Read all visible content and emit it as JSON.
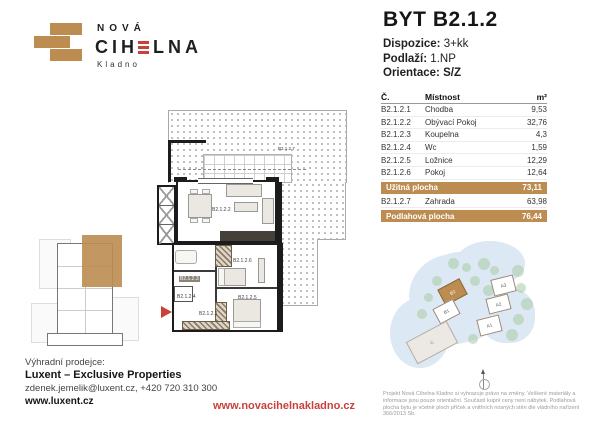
{
  "colors": {
    "brand_tan": "#BC8C50",
    "brand_red": "#C8423C",
    "wall_black": "#1c1c1c",
    "siteplan_blue": "#DCE8F3",
    "tree_green": "#A9CBA4"
  },
  "logo": {
    "line1": "NOVÁ",
    "word_pre": "CIH",
    "word_post": "LNA",
    "city": "Kladno"
  },
  "unit": {
    "title": "BYT B2.1.2",
    "specs": [
      {
        "label": "Dispozice:",
        "value": "3+kk"
      },
      {
        "label": "Podlaží:",
        "value": "1.NP"
      },
      {
        "label": "Orientace:",
        "value": "S/Z"
      }
    ]
  },
  "table": {
    "col_num": "Č.",
    "col_room": "Místnost",
    "col_area": "m²",
    "rows": [
      {
        "num": "B2.1.2.1",
        "room": "Chodba",
        "area": "9,53"
      },
      {
        "num": "B2.1.2.2",
        "room": "Obývací Pokoj",
        "area": "32,76"
      },
      {
        "num": "B2.1.2.3",
        "room": "Koupelna",
        "area": "4,3"
      },
      {
        "num": "B2.1.2.4",
        "room": "Wc",
        "area": "1,59"
      },
      {
        "num": "B2.1.2.5",
        "room": "Ložnice",
        "area": "12,29"
      },
      {
        "num": "B2.1.2.6",
        "room": "Pokoj",
        "area": "12,64"
      }
    ],
    "usable": {
      "label": "Užitná plocha",
      "area": "73,11"
    },
    "garden_row": {
      "num": "B2.1.2.7",
      "room": "Zahrada",
      "area": "63,98"
    },
    "floor_total": {
      "label": "Podlahová plocha",
      "area": "76,44"
    }
  },
  "floorplan": {
    "labels": {
      "living": "B2.1.2.2",
      "garden": "B2.1.2.7",
      "hall": "B2.1.2.1",
      "bath": "B2.1.2.3",
      "wc": "B2.1.2.4",
      "bedroom": "B2.1.2.5",
      "room": "B2.1.2.6"
    }
  },
  "siteplan": {
    "buildings": [
      {
        "label": "B2"
      },
      {
        "label": "B1"
      },
      {
        "label": "A3"
      },
      {
        "label": "A2"
      },
      {
        "label": "A1"
      },
      {
        "label": "C"
      }
    ]
  },
  "footer": {
    "seller_label": "Výhradní prodejce:",
    "seller_name": "Luxent – Exclusive Properties",
    "contact": "zdenek.jemelik@luxent.cz, +420 720 310 300",
    "seller_web": "www.luxent.cz",
    "project_web": "www.novacihelnakladno.cz",
    "disclaimer": "Projekt Nová Cihelna Kladno si vyhrazuje právo na změny. Veškeré materiály a informace jsou pouze orientační. Součástí kupní ceny není nábytek. Podlahová plocha bytu je včetně ploch příček a vnitřních nosných stěn dle vládního nařízení 366/2013 Sb."
  }
}
